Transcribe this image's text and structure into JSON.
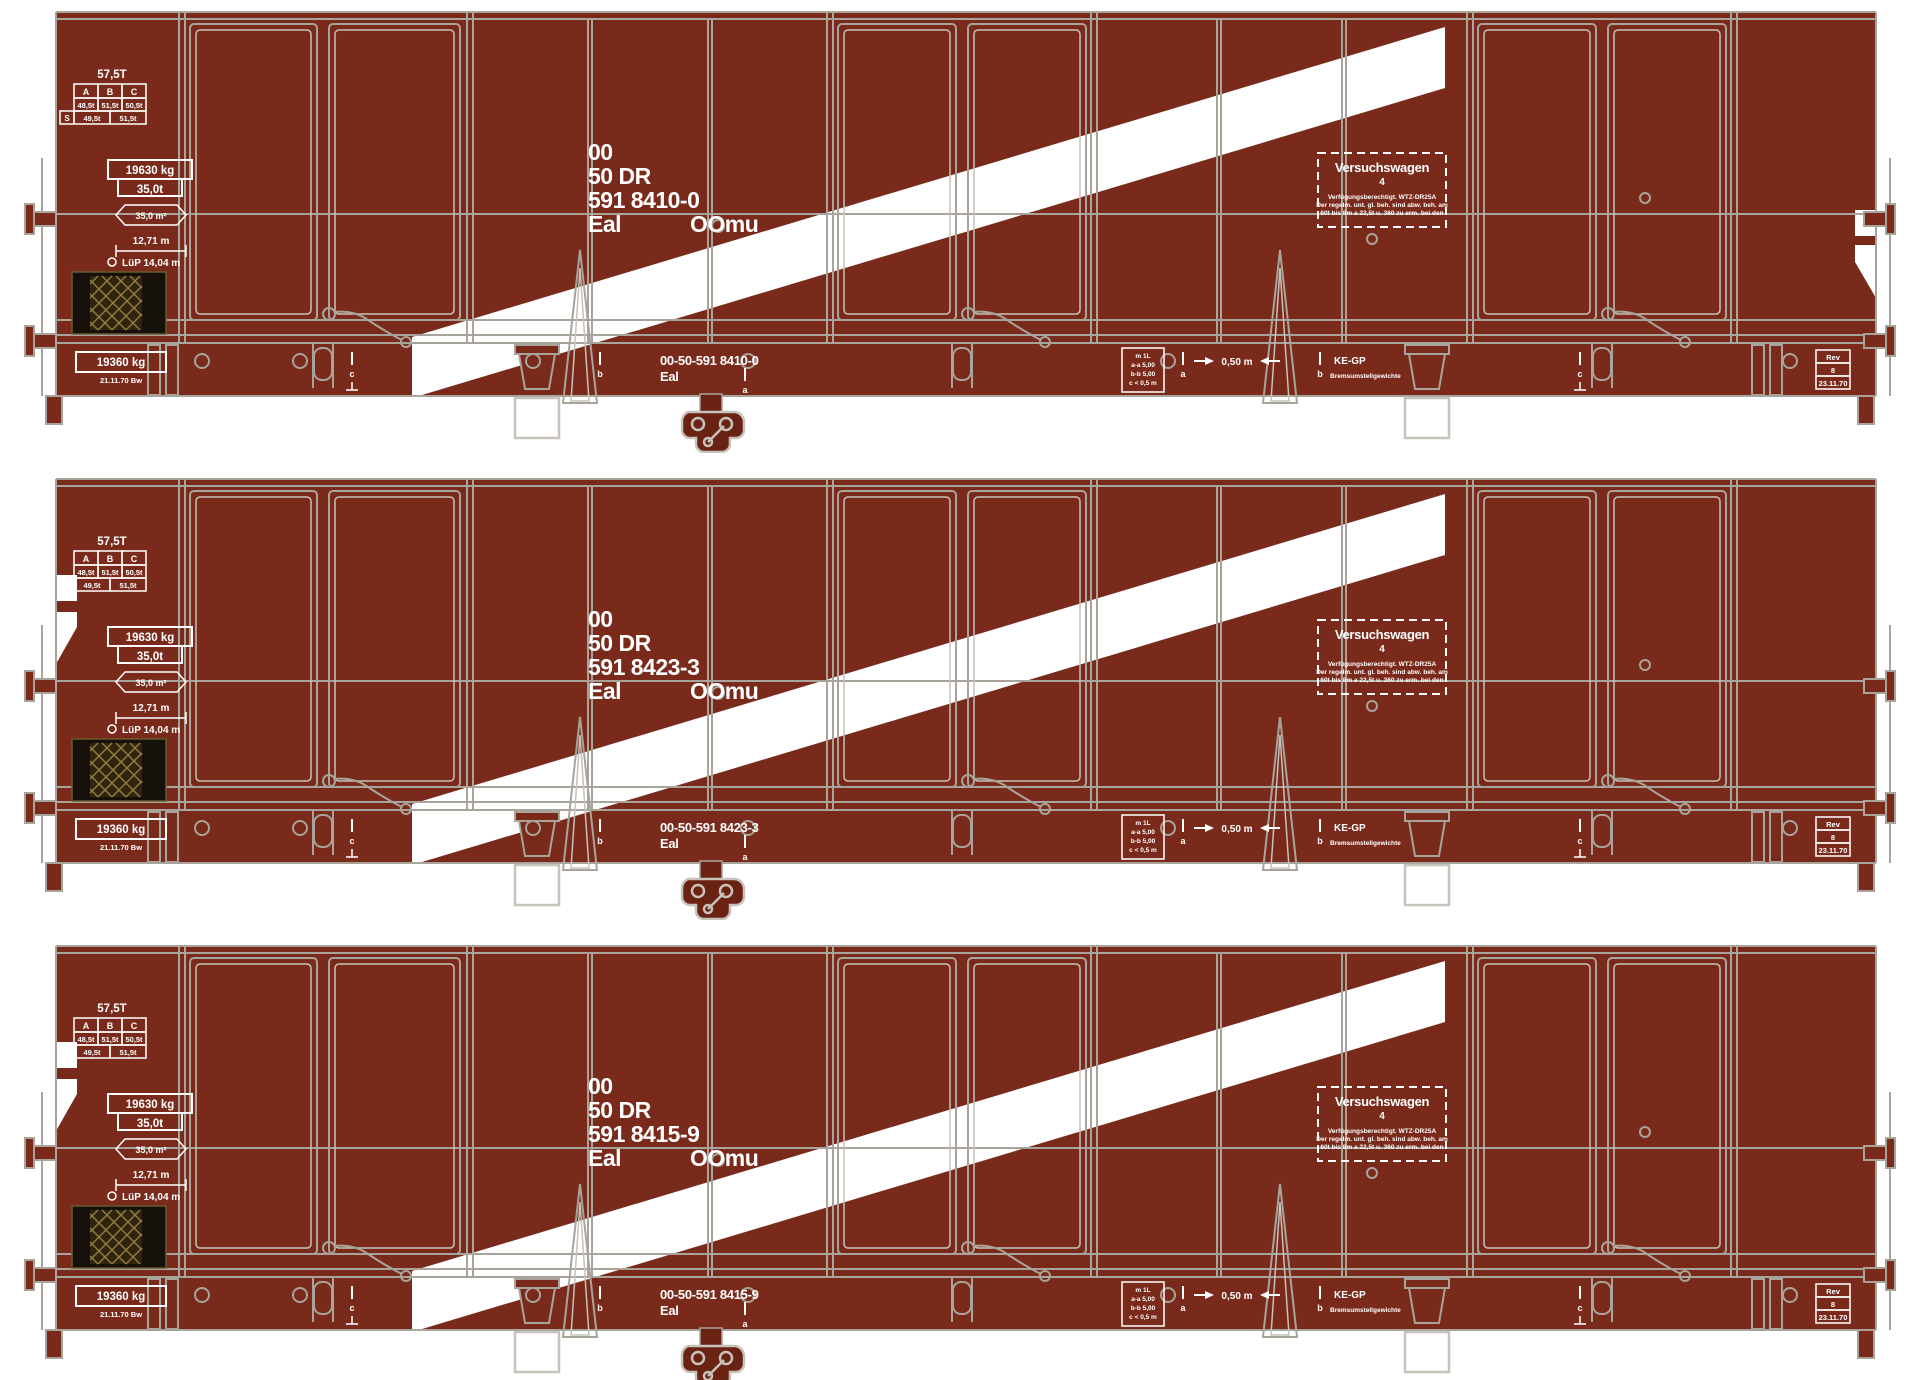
{
  "figure": "three-wagon-set-illustration",
  "colors": {
    "background": "#ffffff",
    "body_brown": "#7a2a1b",
    "stripe_white": "#ffffff",
    "line_gray": "#a8a49c",
    "line_light": "#c7c2ba",
    "panel_black": "#16100a",
    "mesh_gold": "#937d3c",
    "coupler_dark": "#6a2312",
    "marking_white": "#ffffff"
  },
  "shared": {
    "tare_note": "57,5T",
    "load_table": {
      "headers": [
        "A",
        "B",
        "C"
      ],
      "row1": [
        "48,5t",
        "51,5t",
        "50,5t"
      ],
      "row2_label": "S",
      "row2": [
        "49,5t",
        "51,5t"
      ]
    },
    "payload_box": {
      "top": "19630 kg",
      "bottom": "35,0t"
    },
    "floor_area": "35,0 m²",
    "inner_length": "12,71 m",
    "overall_length": "LüP 14,04 m",
    "experimental_box": {
      "title": "Versuchswagen",
      "number": "4",
      "line1": "Verfügungsberechtigt. WTZ-DR25A",
      "line2": "Der regelm. unt. gl. beh. sind abw. beh. am",
      "line3": "60t bis 8m a 22,5t u. 360 zu erm. bei den"
    },
    "tare_box": "19360 kg",
    "tare_date": "21.11.70 Bw",
    "axle_table": {
      "r0": "m 1L",
      "r1": "a-a 5,00",
      "r2": "b-b 5,00",
      "r3": "c < 0,5 m"
    },
    "gauge": "0,50 m",
    "brake": "KE-GP",
    "brake_note": "Bremsumstellgewichte",
    "rev_box": {
      "r0": "Rev",
      "r1": "8",
      "r2": "23.11.70"
    },
    "tick_labels": [
      "c",
      "b",
      "a",
      "a",
      "b",
      "c"
    ]
  },
  "wagons": [
    {
      "owner": "00",
      "admin": "50 DR",
      "number": "591 8410-0",
      "type": "Eal",
      "class_code": "OOmu",
      "frame_number": "00-50-591 8410-0",
      "frame_type": "Eal",
      "corner_mark_side": "right"
    },
    {
      "owner": "00",
      "admin": "50 DR",
      "number": "591 8423-3",
      "type": "Eal",
      "class_code": "OOmu",
      "frame_number": "00-50-591 8423-3",
      "frame_type": "Eal",
      "corner_mark_side": "left"
    },
    {
      "owner": "00",
      "admin": "50 DR",
      "number": "591 8415-9",
      "type": "Eal",
      "class_code": "OOmu",
      "frame_number": "00-50-591 8415-9",
      "frame_type": "Eal",
      "corner_mark_side": "left"
    }
  ]
}
